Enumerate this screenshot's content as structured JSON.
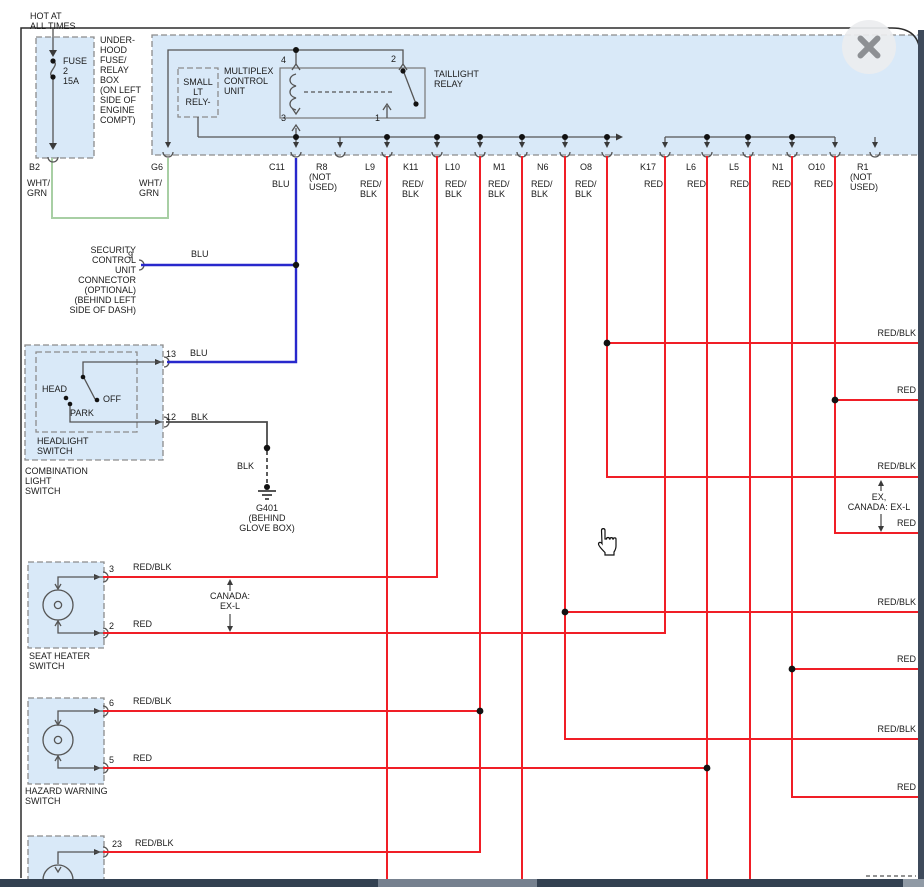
{
  "top": {
    "hot": "HOT AT\nALL TIMES",
    "fuse": "FUSE\n2\n15A",
    "underhood": "UNDER-\nHOOD\nFUSE/\nRELAY\nBOX\n(ON LEFT\nSIDE OF\nENGINE\nCOMPT)",
    "small_relay": "SMALL\nLT\nRELY-",
    "multiplex": "MULTIPLEX\nCONTROL\nUNIT",
    "taillight": "TAILLIGHT\nRELAY",
    "p4": "4",
    "p2": "2",
    "p3": "3",
    "p1": "1"
  },
  "connectors": [
    {
      "name": "B2",
      "wire": "WHT/\nGRN"
    },
    {
      "name": "G6",
      "wire": "WHT/\nGRN"
    },
    {
      "name": "C11",
      "wire": "BLU"
    },
    {
      "name": "R8",
      "note": "(NOT\nUSED)"
    },
    {
      "name": "L9",
      "wire": "RED/\nBLK"
    },
    {
      "name": "K11",
      "wire": "RED/\nBLK"
    },
    {
      "name": "L10",
      "wire": "RED/\nBLK"
    },
    {
      "name": "M1",
      "wire": "RED/\nBLK"
    },
    {
      "name": "N6",
      "wire": "RED/\nBLK"
    },
    {
      "name": "O8",
      "wire": "RED/\nBLK"
    },
    {
      "name": "K17",
      "wire": "RED"
    },
    {
      "name": "L6",
      "wire": "RED"
    },
    {
      "name": "L5",
      "wire": "RED"
    },
    {
      "name": "N1",
      "wire": "RED"
    },
    {
      "name": "O10",
      "wire": "RED"
    },
    {
      "name": "R1",
      "note": "(NOT\nUSED)"
    }
  ],
  "security": {
    "label": "SECURITY\nCONTROL\nUNIT\nCONNECTOR\n(OPTIONAL)\n(BEHIND LEFT\nSIDE OF DASH)",
    "pin": "9",
    "wire": "BLU"
  },
  "combo": {
    "head": "HEAD",
    "off": "OFF",
    "park": "PARK",
    "headlight": "HEADLIGHT\nSWITCH",
    "title": "COMBINATION\nLIGHT\nSWITCH",
    "pin13": "13",
    "pin13_wire": "BLU",
    "pin12": "12",
    "pin12_wire": "BLK"
  },
  "ground": {
    "wire": "BLK",
    "label": "G401\n(BEHIND\nGLOVE BOX)"
  },
  "seat": {
    "title": "SEAT HEATER\nSWITCH",
    "pin3": "3",
    "pin3_wire": "RED/BLK",
    "pin2": "2",
    "pin2_wire": "RED",
    "canada": "CANADA:\nEX-L"
  },
  "hazard": {
    "title": "HAZARD WARNING\n SWITCH",
    "pin6": "6",
    "pin6_wire": "RED/BLK",
    "pin5": "5",
    "pin5_wire": "RED"
  },
  "bottom_switch": {
    "pin23": "23",
    "pin23_wire": "RED/BLK"
  },
  "right_labels": [
    "RED/BLK",
    "RED",
    "RED/BLK",
    "RED",
    "RED/BLK",
    "RED",
    "RED/BLK",
    "RED"
  ],
  "right_note": "EX,\nCANADA: EX-L",
  "colors": {
    "red": "#f01e26",
    "blue": "#2828cc",
    "green": "#a8cfa4",
    "boxfill": "#d9e9f8",
    "chrome": "#3e4a5b"
  }
}
